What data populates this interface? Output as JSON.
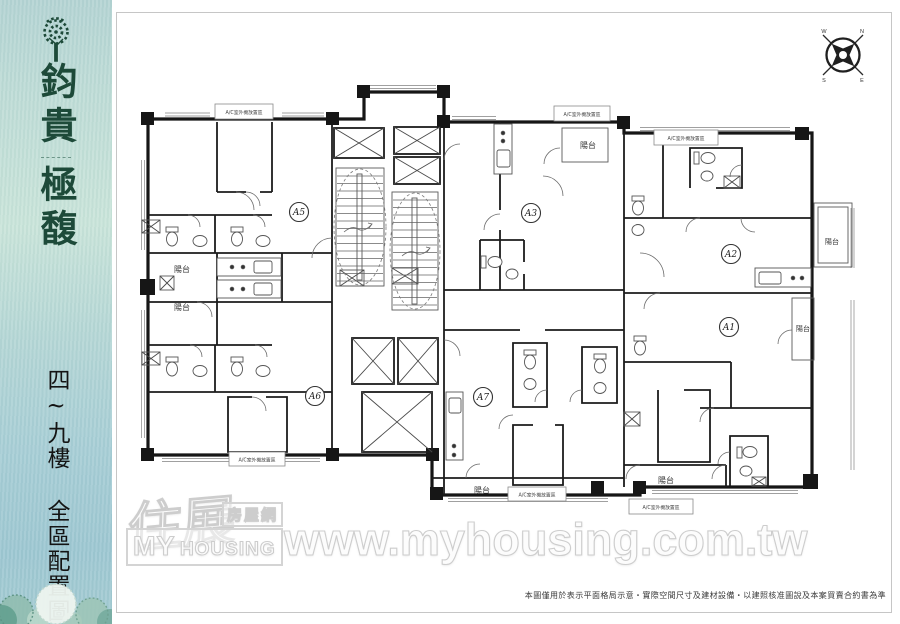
{
  "sidebar": {
    "brand_line1": "鈞貴",
    "brand_line2": "極馥",
    "subtitle": "四~九樓 全區配置圖"
  },
  "compass": {
    "n": "N",
    "e": "E",
    "s": "S",
    "w": "W"
  },
  "plan": {
    "units": [
      {
        "label": "A5"
      },
      {
        "label": "A3"
      },
      {
        "label": "A2"
      },
      {
        "label": "A1"
      },
      {
        "label": "A6"
      },
      {
        "label": "A7"
      }
    ],
    "balcony_label": "陽台",
    "ac_label": "A/C室外機放置區"
  },
  "watermark": {
    "logo_cn_main": "住展",
    "logo_cn_sub": "房屋網",
    "logo_en_top": "MY",
    "logo_en_bottom": "HOUSING",
    "url": "www.myhousing.com.tw"
  },
  "footer": {
    "disclaimer": "本圖僅用於表示平面格局示意‧實際空間尺寸及建材設備‧以建照核准圖說及本案買賣合約書為準"
  },
  "colors": {
    "brand_green": "#1d4a39",
    "wall_black": "#161616",
    "watermark_gray": "#cdcdcd",
    "sidebar_blue": "#a8cfd6"
  }
}
